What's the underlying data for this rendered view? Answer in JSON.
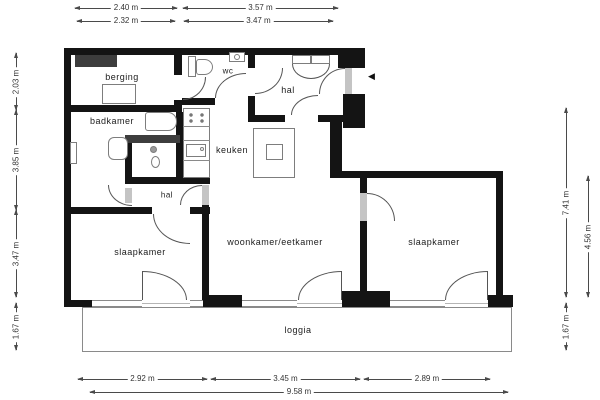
{
  "rooms": {
    "berging": "berging",
    "wc": "wc",
    "hal_entrance": "hal",
    "badkamer": "badkamer",
    "keuken": "keuken",
    "hal_inner": "hal",
    "slaapkamer_left": "slaapkamer",
    "woonkamer": "woonkamer/eetkamer",
    "slaapkamer_right": "slaapkamer",
    "loggia": "loggia"
  },
  "dims": {
    "top": [
      "2.40 m",
      "3.57 m",
      "2.32 m",
      "3.47 m"
    ],
    "left": [
      "2.03 m",
      "3.85 m",
      "3.47 m",
      "1.67 m"
    ],
    "right": [
      "7.41 m",
      "4.56 m",
      "1.67 m"
    ],
    "bottom": [
      "2.92 m",
      "3.45 m",
      "2.89 m",
      "9.58 m"
    ]
  },
  "icons": {
    "entrance_arrow": "◀"
  },
  "colors": {
    "wall": "#141414",
    "dimension_line": "#4a4a4a",
    "fixture_border": "#7d7d7d",
    "built_in_closet": "#3d3d3d",
    "door_jamb": "#c4c4c4"
  }
}
